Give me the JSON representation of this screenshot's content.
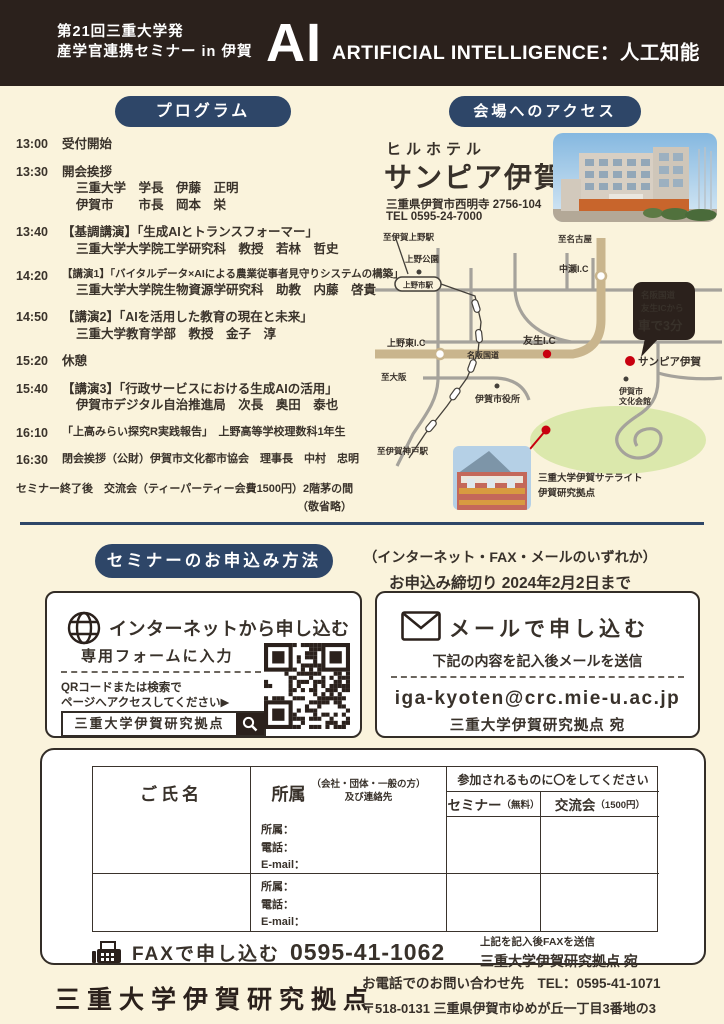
{
  "colors": {
    "background": "#faf3dc",
    "header": "#2b211c",
    "navy_pill": "#2e4668",
    "accent_red": "#c8000f",
    "highway_tan": "#c9b58d",
    "ink": "#38312a"
  },
  "header": {
    "series_line1": "第21回三重大学発",
    "series_line2": "産学官連携セミナー in 伊賀",
    "ai": "AI",
    "ai_sub": "ARTIFICIAL INTELLIGENCE：人工知能"
  },
  "program": {
    "pill_label": "プログラム",
    "items": [
      {
        "time": "13:00",
        "title": "受付開始",
        "lines": []
      },
      {
        "time": "13:30",
        "title": "開会挨拶",
        "lines": [
          "三重大学　学長　伊藤　正明",
          "伊賀市　　市長　岡本　栄"
        ]
      },
      {
        "time": "13:40",
        "title": "【基調講演】「生成AIとトランスフォーマー」",
        "lines": [
          "三重大学大学院工学研究科　教授　若林　哲史"
        ]
      },
      {
        "time": "14:20",
        "title": "【講演1】「バイタルデータ×AIによる農業従事者見守りシステムの構築」",
        "lines": [
          "三重大学大学院生物資源学研究科　助教　内藤　啓貴"
        ]
      },
      {
        "time": "14:50",
        "title": "【講演2】「AIを活用した教育の現在と未来」",
        "lines": [
          "三重大学教育学部　教授　金子　淳"
        ]
      },
      {
        "time": "15:20",
        "title": "休憩",
        "lines": []
      },
      {
        "time": "15:40",
        "title": "【講演3】「行政サービスにおける生成AIの活用」",
        "lines": [
          "伊賀市デジタル自治推進局　次長　奥田　泰也"
        ]
      },
      {
        "time": "16:10",
        "title": "「上高みらい探究R実践報告」　上野高等学校理数科1年生",
        "lines": []
      },
      {
        "time": "16:30",
        "title": "閉会挨拶（公財）伊賀市文化都市協会　理事長　中村　忠明",
        "lines": []
      }
    ],
    "after_note": "セミナー終了後　交流会（ティーパーティー会費1500円）2階茅の間",
    "honorifics_note": "（敬省略）"
  },
  "access": {
    "pill_label": "会場へのアクセス",
    "hotel_type": "ヒルホテル",
    "hotel_name": "サンピア伊賀",
    "address": "三重県伊賀市西明寺 2756-104",
    "tel": "TEL 0595-24-7000",
    "map": {
      "to_ueno_station": "至伊賀上野駅",
      "ueno_park": "上野公園",
      "uenoshi_station": "上野市駅",
      "to_nagoya": "至名古屋",
      "nakase_ic": "中瀬I.C",
      "ueno_higashi_ic": "上野東I.C",
      "meihan_road": "名阪国道",
      "tomono_ic": "友生I.C",
      "to_osaka": "至大阪",
      "city_hall": "伊賀市役所",
      "sanpia_label": "サンピア伊賀",
      "culture_hall_1": "伊賀市",
      "culture_hall_2": "文化会館",
      "to_igakambe": "至伊賀神戸駅",
      "bubble_1": "名阪国道",
      "bubble_2": "友生ICから",
      "bubble_3": "車で3分",
      "satellite_1": "三重大学伊賀サテライト",
      "satellite_2": "伊賀研究拠点"
    }
  },
  "apply": {
    "pill_label": "セミナーのお申込み方法",
    "method_note": "（インターネット・FAX・メールのいずれか）",
    "deadline_note": "お申込み締切り 2024年2月2日まで",
    "internet": {
      "title": "インターネットから申し込む",
      "sub": "専用フォームに入力",
      "qr_line1": "QRコードまたは検索で",
      "qr_line2": "ページへアクセスしてください▶",
      "search_value": "三重大学伊賀研究拠点"
    },
    "mail": {
      "title": "メールで申し込む",
      "sub": "下記の内容を記入後メールを送信",
      "email": "iga-kyoten@crc.mie-u.ac.jp",
      "recipient": "三重大学伊賀研究拠点 宛"
    },
    "form": {
      "col_name": "ご氏名",
      "col_affiliation": "所属",
      "col_affiliation_note1": "（会社・団体・一般の方）",
      "col_affiliation_note2": "及び連絡先",
      "participate_header": "参加されるものに〇をしてください",
      "col_seminar": "セミナー",
      "col_seminar_note": "（無料）",
      "col_party": "交流会",
      "col_party_note": "（1500円）",
      "field_affiliation": "所属：",
      "field_phone": "電話：",
      "field_email": "E-mail："
    },
    "fax": {
      "label": "FAXで申し込む",
      "number": "0595-41-1062",
      "note1": "上記を記入後FAXを送信",
      "note2": "三重大学伊賀研究拠点 宛"
    }
  },
  "footer": {
    "org": "三重大学伊賀研究拠点",
    "tel_line": "お電話でのお問い合わせ先　TEL：0595-41-1071",
    "address_line": "〒518-0131 三重県伊賀市ゆめが丘一丁目3番地の3"
  }
}
